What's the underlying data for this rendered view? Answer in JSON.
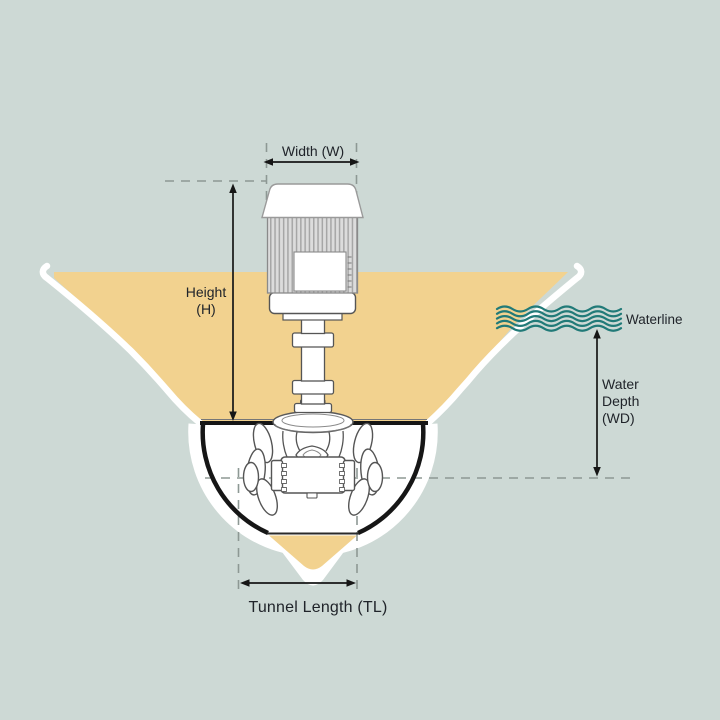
{
  "diagram": {
    "name": "bow-thruster-dimension-diagram",
    "labels": {
      "width": "Width (W)",
      "height": "Height\n(H)",
      "waterline": "Waterline",
      "water_depth": "Water\nDepth\n(WD)",
      "tunnel_length": "Tunnel Length (TL)"
    },
    "colors": {
      "background": "#cdd9d5",
      "hull": "#f2d28f",
      "hull_outline": "#ffffff",
      "waterline": "#217a78",
      "text": "#20242a",
      "dimension": "#161616",
      "dashed": "#8d9894",
      "linework": "#555555"
    }
  }
}
